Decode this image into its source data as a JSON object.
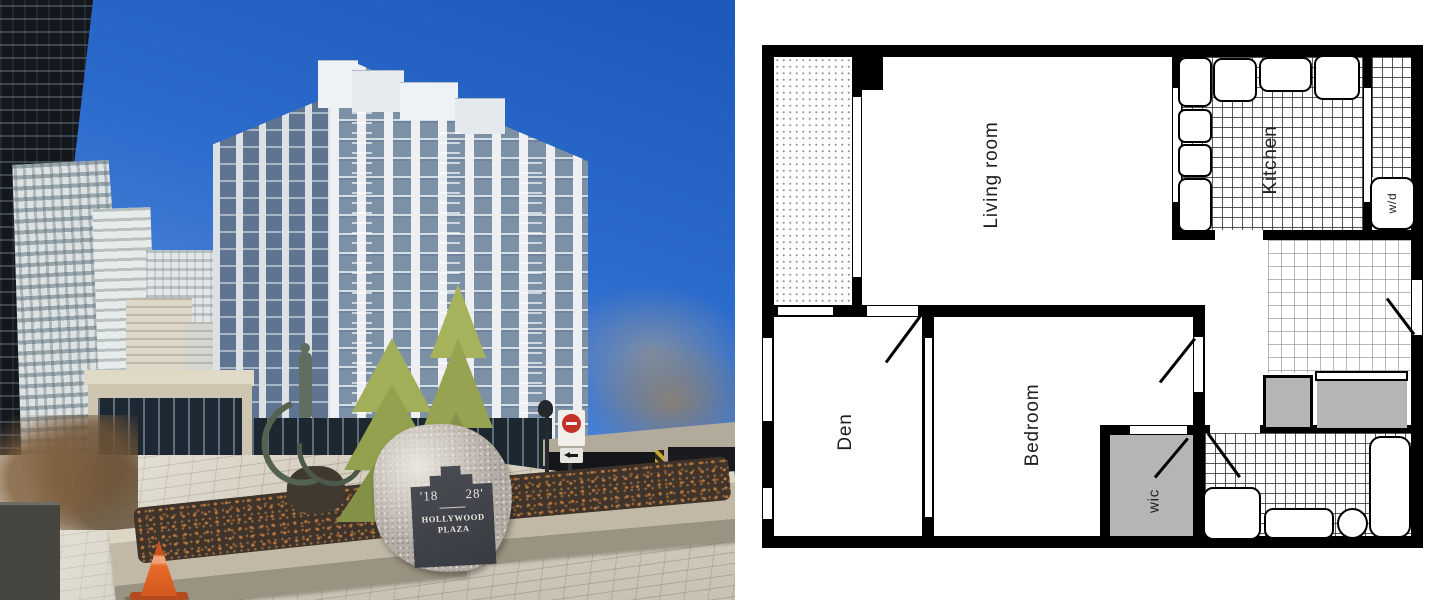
{
  "image": {
    "description": "Real-estate listing composite: condo building exterior photo (left) and apartment floor plan (right)",
    "width": 1440,
    "height": 600
  },
  "photo": {
    "sign": {
      "number_left": "'18",
      "number_right": "28'",
      "name_top": "HOLLYWOOD",
      "name_bottom": "PLAZA"
    },
    "colors": {
      "sky_top": "#1d5abc",
      "sky_low": "#96b8ec",
      "paving": "#cfc9ba",
      "cone_orange": "#e66a28",
      "planter_stone": "#c1b9a6",
      "sculpture_bronze": "#54624f",
      "conifer_green": "#9aa653"
    }
  },
  "floor_plan": {
    "colors": {
      "wall": "#000000",
      "background": "#ffffff",
      "closet_fill": "#b5b5b5"
    },
    "rooms": {
      "living": {
        "label": "Living room"
      },
      "kitchen": {
        "label": "Kitchen"
      },
      "den": {
        "label": "Den"
      },
      "bedroom": {
        "label": "Bedroom"
      },
      "wic": {
        "label": "wic"
      },
      "wd": {
        "label": "w/d"
      }
    }
  }
}
